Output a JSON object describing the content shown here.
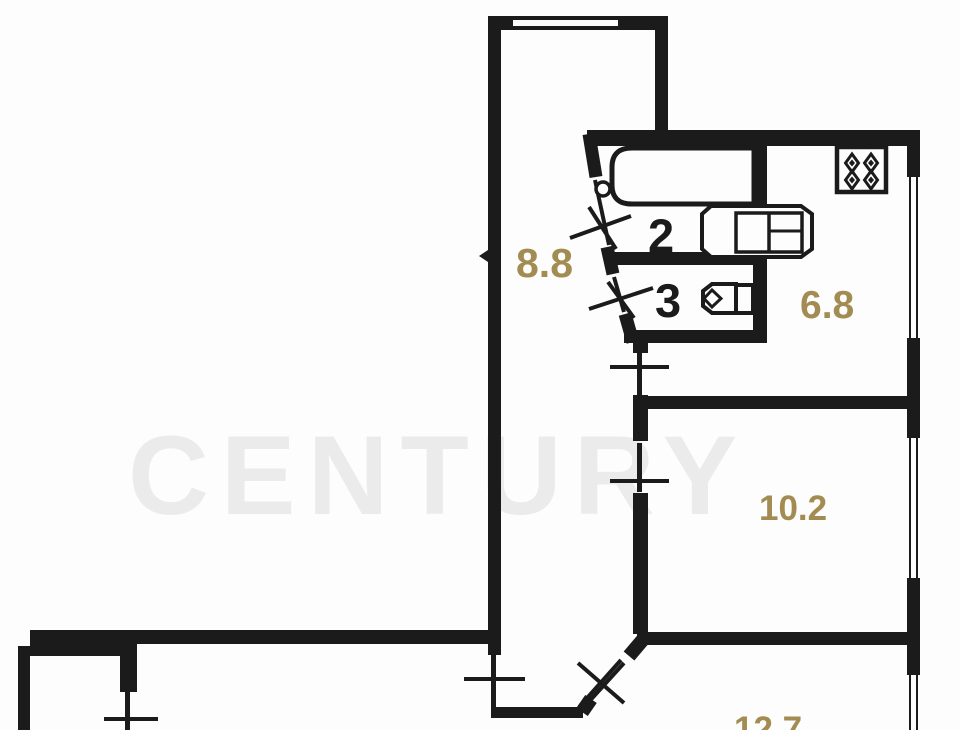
{
  "floorplan": {
    "watermark_text": "CENTURY",
    "labels": {
      "corridor_area": "8.8",
      "bathroom_number": "2",
      "wc_number": "3",
      "kitchen_area": "6.8",
      "room_a_area": "10.2",
      "room_b_area": "12.7"
    },
    "colors": {
      "wall": "#1b1b1b",
      "area-label": "#a28c52",
      "room-number": "#1b1b1b",
      "watermark": "#ebebeb",
      "background": "#fdfdfd"
    },
    "icons": {
      "bathtub": "bathtub-icon",
      "toilet": "toilet-icon",
      "sink": "sink-icon",
      "stove": "stove-icon",
      "door_marks": "door-swing-icon",
      "windows": "window"
    }
  }
}
